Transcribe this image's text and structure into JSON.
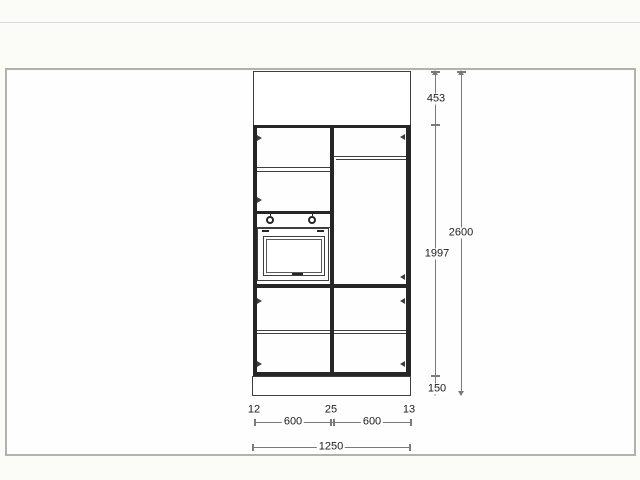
{
  "colors": {
    "line": "#3f3f3f",
    "thick": "#262626",
    "dim": "#7a7a7a",
    "text": "#1c1c1c",
    "frame": "#b4b0ad"
  },
  "dims": {
    "top_gap": "453",
    "upper_body": "1997",
    "plinth": "150",
    "total_height": "2600",
    "left_filler": "12",
    "center_gap": "25",
    "right_filler": "13",
    "left_unit_width": "600",
    "right_unit_width": "600",
    "total_width": "1250"
  }
}
